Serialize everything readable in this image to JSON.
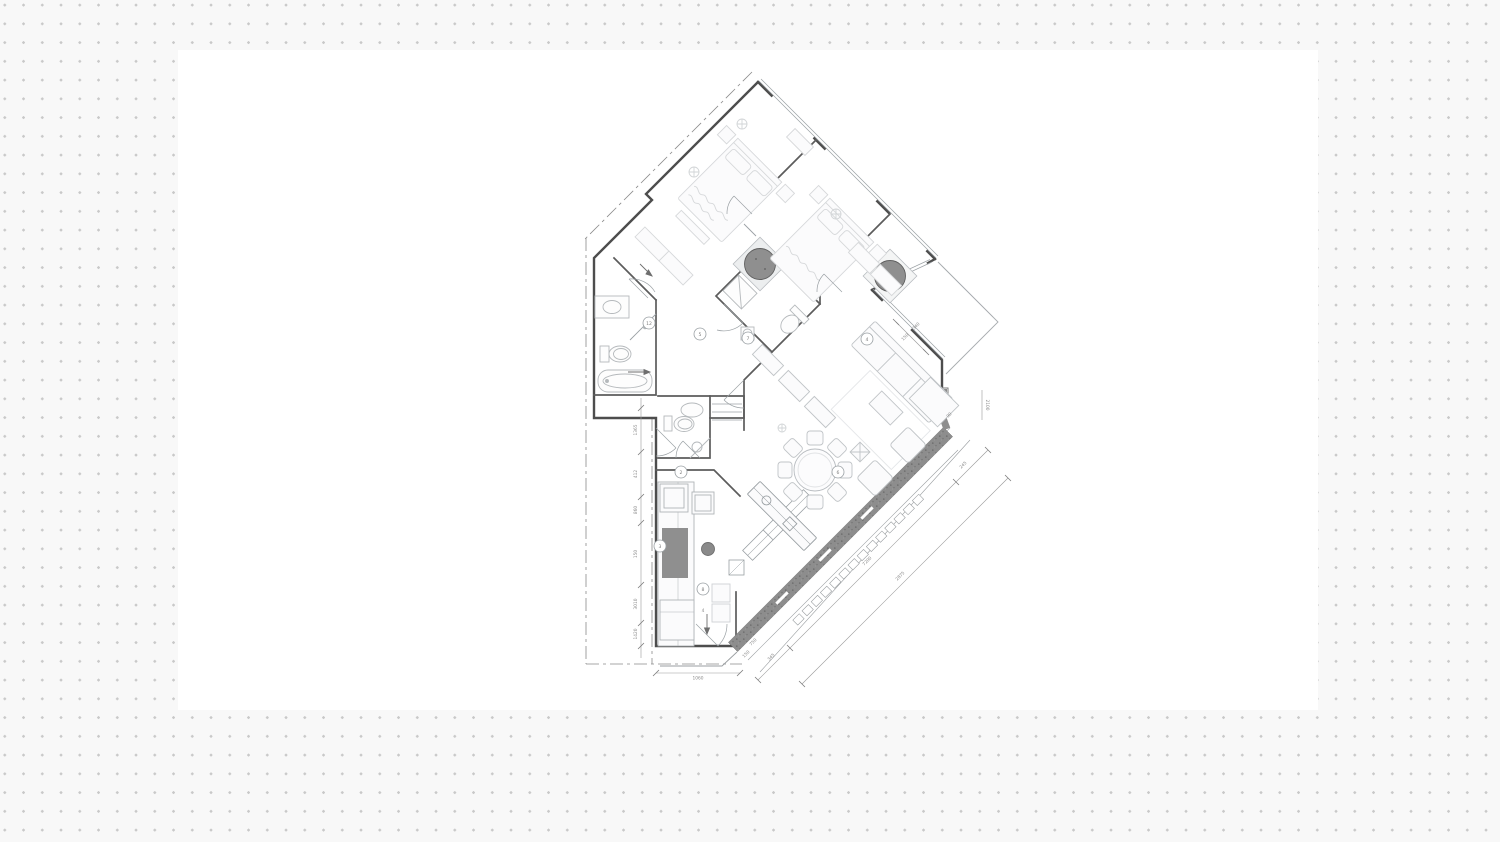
{
  "canvas": {
    "width": 1500,
    "height": 842,
    "background_color": "#f8f8f8",
    "dot_color": "#c9c9c9",
    "dot_spacing_px": 18.75
  },
  "sheet": {
    "x": 178,
    "y": 50,
    "width": 1140,
    "height": 660,
    "color": "#ffffff"
  },
  "plan": {
    "colors": {
      "outer_wall": "#4d4d4d",
      "partition": "#5c5c5c",
      "glass": "#9aa0a4",
      "furniture": "#b9bdc1",
      "furniture_faint": "#d6d8da",
      "column_fill": "#8f8f8f",
      "column_edge": "#5f5f5f",
      "facade_band": "#8d8d8d",
      "counter_dark": "#8f8f8f",
      "dashdot": "#8a8a8a",
      "dimension": "#8c8c8c"
    },
    "dimensions": {
      "left_chain": [
        "1365",
        "412",
        "860",
        "150",
        "3010",
        "1420"
      ],
      "bottom": "1060",
      "facade_chain": [
        "345",
        "7200",
        "245",
        "2875"
      ],
      "misc": [
        "750",
        "150",
        "90",
        "2100",
        "150",
        "340"
      ]
    },
    "tags": [
      "5",
      "12",
      "2",
      "3",
      "8",
      "7",
      "4",
      "6"
    ],
    "section_marker": "4"
  }
}
